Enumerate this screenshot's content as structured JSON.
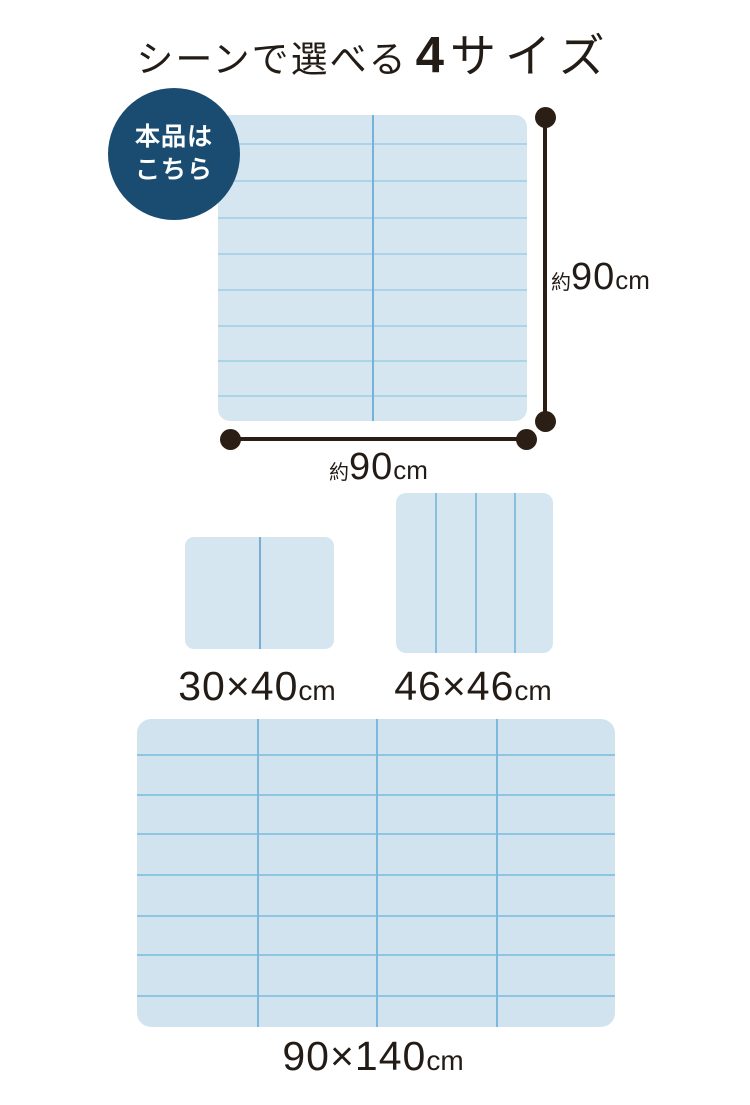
{
  "title": {
    "prefix": "シーンで選べる",
    "number": "4",
    "suffix": "サイズ"
  },
  "badge": {
    "line1": "本品は",
    "line2": "こちら",
    "bg_color": "#1a4c72",
    "text_color": "#ffffff"
  },
  "colors": {
    "page_bg": "#ffffff",
    "text": "#231c16",
    "dimension": "#2b1f15"
  },
  "mats": [
    {
      "name": "mat-90x90-main",
      "left": 218,
      "top": 115,
      "width": 309,
      "height": 306,
      "radius": 12,
      "fill": "#d5e6f1",
      "vline_color": "#74b2d8",
      "hline_color": "#abd4e8",
      "vlines": [
        153.5
      ],
      "hlines": [
        28,
        65,
        102,
        138,
        174,
        210,
        245,
        280
      ]
    },
    {
      "name": "mat-30x40",
      "left": 185,
      "top": 537,
      "width": 149,
      "height": 112,
      "radius": 9,
      "fill": "#d5e6f1",
      "vline_color": "#79aed2",
      "hline_color": "#abd4e8",
      "vlines": [
        74
      ],
      "hlines": []
    },
    {
      "name": "mat-46x46",
      "left": 396,
      "top": 493,
      "width": 157,
      "height": 160,
      "radius": 10,
      "fill": "#d5e6f1",
      "vline_color": "#87bfdd",
      "hline_color": "#abd4e8",
      "vlines": [
        39,
        78.5,
        118
      ],
      "hlines": []
    },
    {
      "name": "mat-90x140",
      "left": 137,
      "top": 719,
      "width": 478,
      "height": 308,
      "radius": 14,
      "fill": "#d0e3ef",
      "vline_color": "#7cb9da",
      "hline_color": "#8ec6e2",
      "vlines": [
        119.5,
        239,
        358.5
      ],
      "hlines": [
        35,
        75,
        114,
        155,
        196,
        235,
        276
      ]
    }
  ],
  "dimensions": {
    "height": {
      "approx": "約",
      "value": "90",
      "unit": "cm"
    },
    "width": {
      "approx": "約",
      "value": "90",
      "unit": "cm"
    }
  },
  "size_labels": [
    {
      "value": "30×40",
      "unit": "cm"
    },
    {
      "value": "46×46",
      "unit": "cm"
    },
    {
      "value": "90×140",
      "unit": "cm"
    }
  ]
}
